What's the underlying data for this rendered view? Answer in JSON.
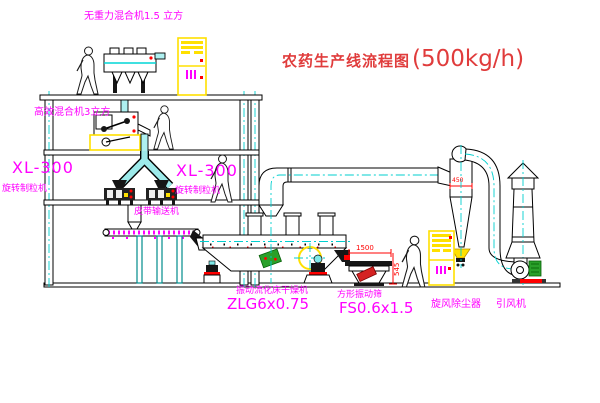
{
  "title": {
    "text": "农药生产线流程图",
    "capacity": "(500kg/h)"
  },
  "labels": {
    "gravity_free_mixer": "无重力混合机1.5 立方",
    "high_efficiency_mixer": "高效混合机3立方",
    "granulator_left_model": "XL-300",
    "granulator_left_name": "旋转制粒机",
    "granulator_center_model": "XL-300",
    "granulator_center_name": "旋转制粒机",
    "belt_conveyor": "皮带输送机",
    "fluid_bed_dryer_name": "振动流化床干燥机",
    "fluid_bed_dryer_model": "ZLG6x0.75",
    "vibrating_screen_name": "方形振动筛",
    "vibrating_screen_model": "FS0.6x1.5",
    "cyclone_dust_collector": "旋风除尘器",
    "induced_draft_fan": "引风机"
  },
  "dimensions": {
    "screen_length": "1500",
    "screen_height": "545",
    "cyclone_diameter": "450"
  },
  "colors": {
    "label_magenta": "#ff00ff",
    "title_red": "#e03c3c",
    "pipe_cyan": "#9deaea",
    "centerline_cyan": "#00cfcf",
    "cabinet_yellow": "#ffe000",
    "alert_red": "#ff0000",
    "motor_green": "#2aa02a"
  }
}
